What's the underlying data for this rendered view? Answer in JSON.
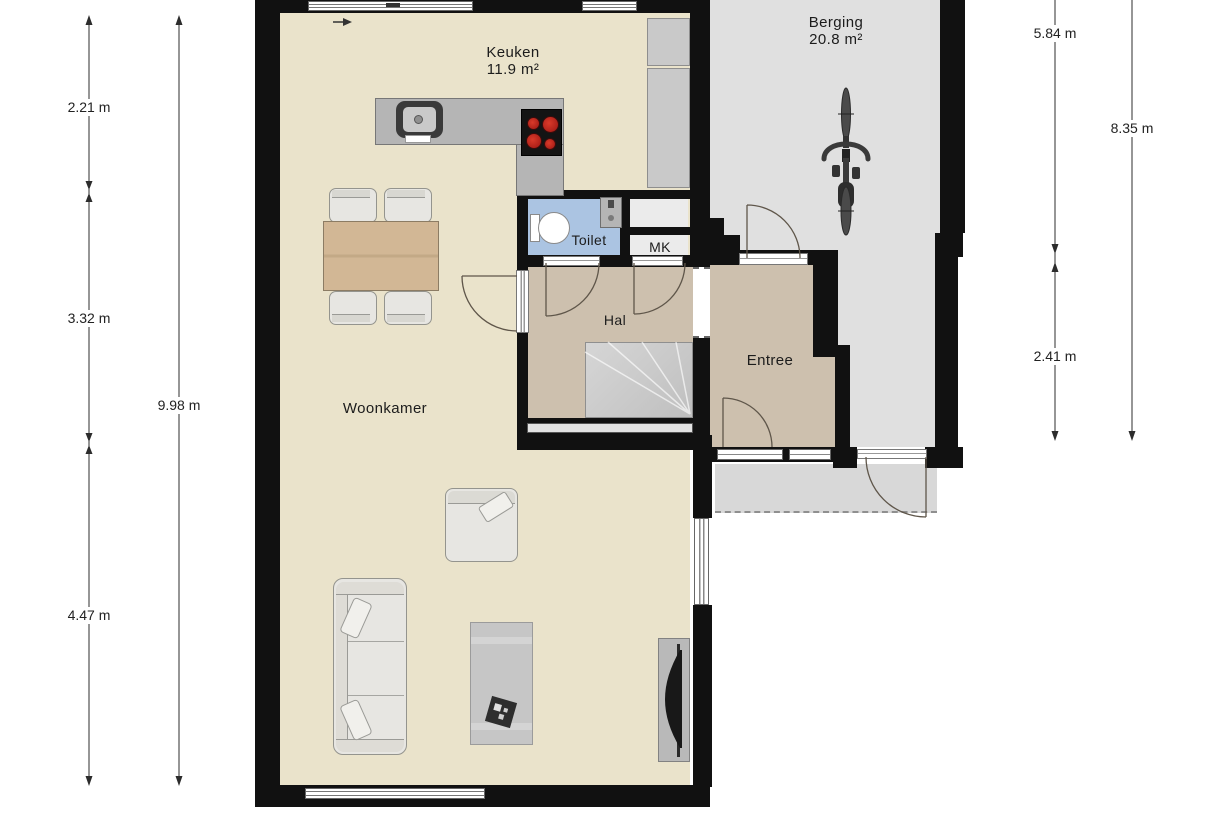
{
  "rooms": {
    "keuken": {
      "label": "Keuken",
      "area": "11.9 m²"
    },
    "berging": {
      "label": "Berging",
      "area": "20.8 m²"
    },
    "toilet": {
      "label": "Toilet"
    },
    "mk": {
      "label": "MK"
    },
    "hal": {
      "label": "Hal"
    },
    "entree": {
      "label": "Entree"
    },
    "woonkamer": {
      "label": "Woonkamer"
    }
  },
  "dimensions": {
    "left": {
      "segments": [
        "2.21 m",
        "3.32 m",
        "4.47 m"
      ],
      "total": "9.98 m"
    },
    "right": {
      "segments": [
        "5.84 m",
        "2.41 m"
      ],
      "total": "8.35 m"
    }
  },
  "colors": {
    "wall": "#111111",
    "living_floor": "#eae3cb",
    "hall_floor": "#cdc0ae",
    "storage_floor": "#e0e0e0",
    "toilet_floor": "#abc4e2",
    "counter": "#b5b5b5",
    "stove_burner": "#c42222",
    "porch": "#d8d8d8",
    "wood_table": "#d2b795"
  }
}
